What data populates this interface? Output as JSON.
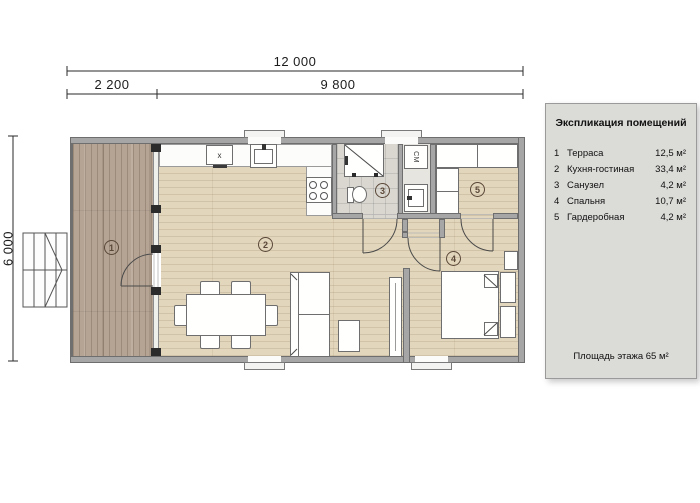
{
  "dimensions": {
    "total_width": "12 000",
    "terrace_width": "2 200",
    "house_width": "9 800",
    "depth": "6 000"
  },
  "plan": {
    "room_numbers": [
      "1",
      "2",
      "3",
      "4",
      "5"
    ],
    "washer_label": "СМ",
    "appliance_label": "x"
  },
  "legend": {
    "title": "Экспликация помещений",
    "rows": [
      {
        "num": "1",
        "name": "Терраса",
        "area": "12,5 м²"
      },
      {
        "num": "2",
        "name": "Кухня-гостиная",
        "area": "33,4 м²"
      },
      {
        "num": "3",
        "name": "Санузел",
        "area": "4,2 м²"
      },
      {
        "num": "4",
        "name": "Спальня",
        "area": "10,7 м²"
      },
      {
        "num": "5",
        "name": "Гардеробная",
        "area": "4,2 м²"
      }
    ],
    "footer": "Площадь этажа 65 м²"
  },
  "colors": {
    "terrace_wood": "#b5a494",
    "interior_floor": "#e2d6bc",
    "bath_tile": "#d9d7d0",
    "wall_gray": "#a6a6a6",
    "wall_outline": "#6e6e6e",
    "legend_bg": "#dbdbd8",
    "room_number_accent": "#5a4738",
    "post_black": "#2b2b2b"
  }
}
